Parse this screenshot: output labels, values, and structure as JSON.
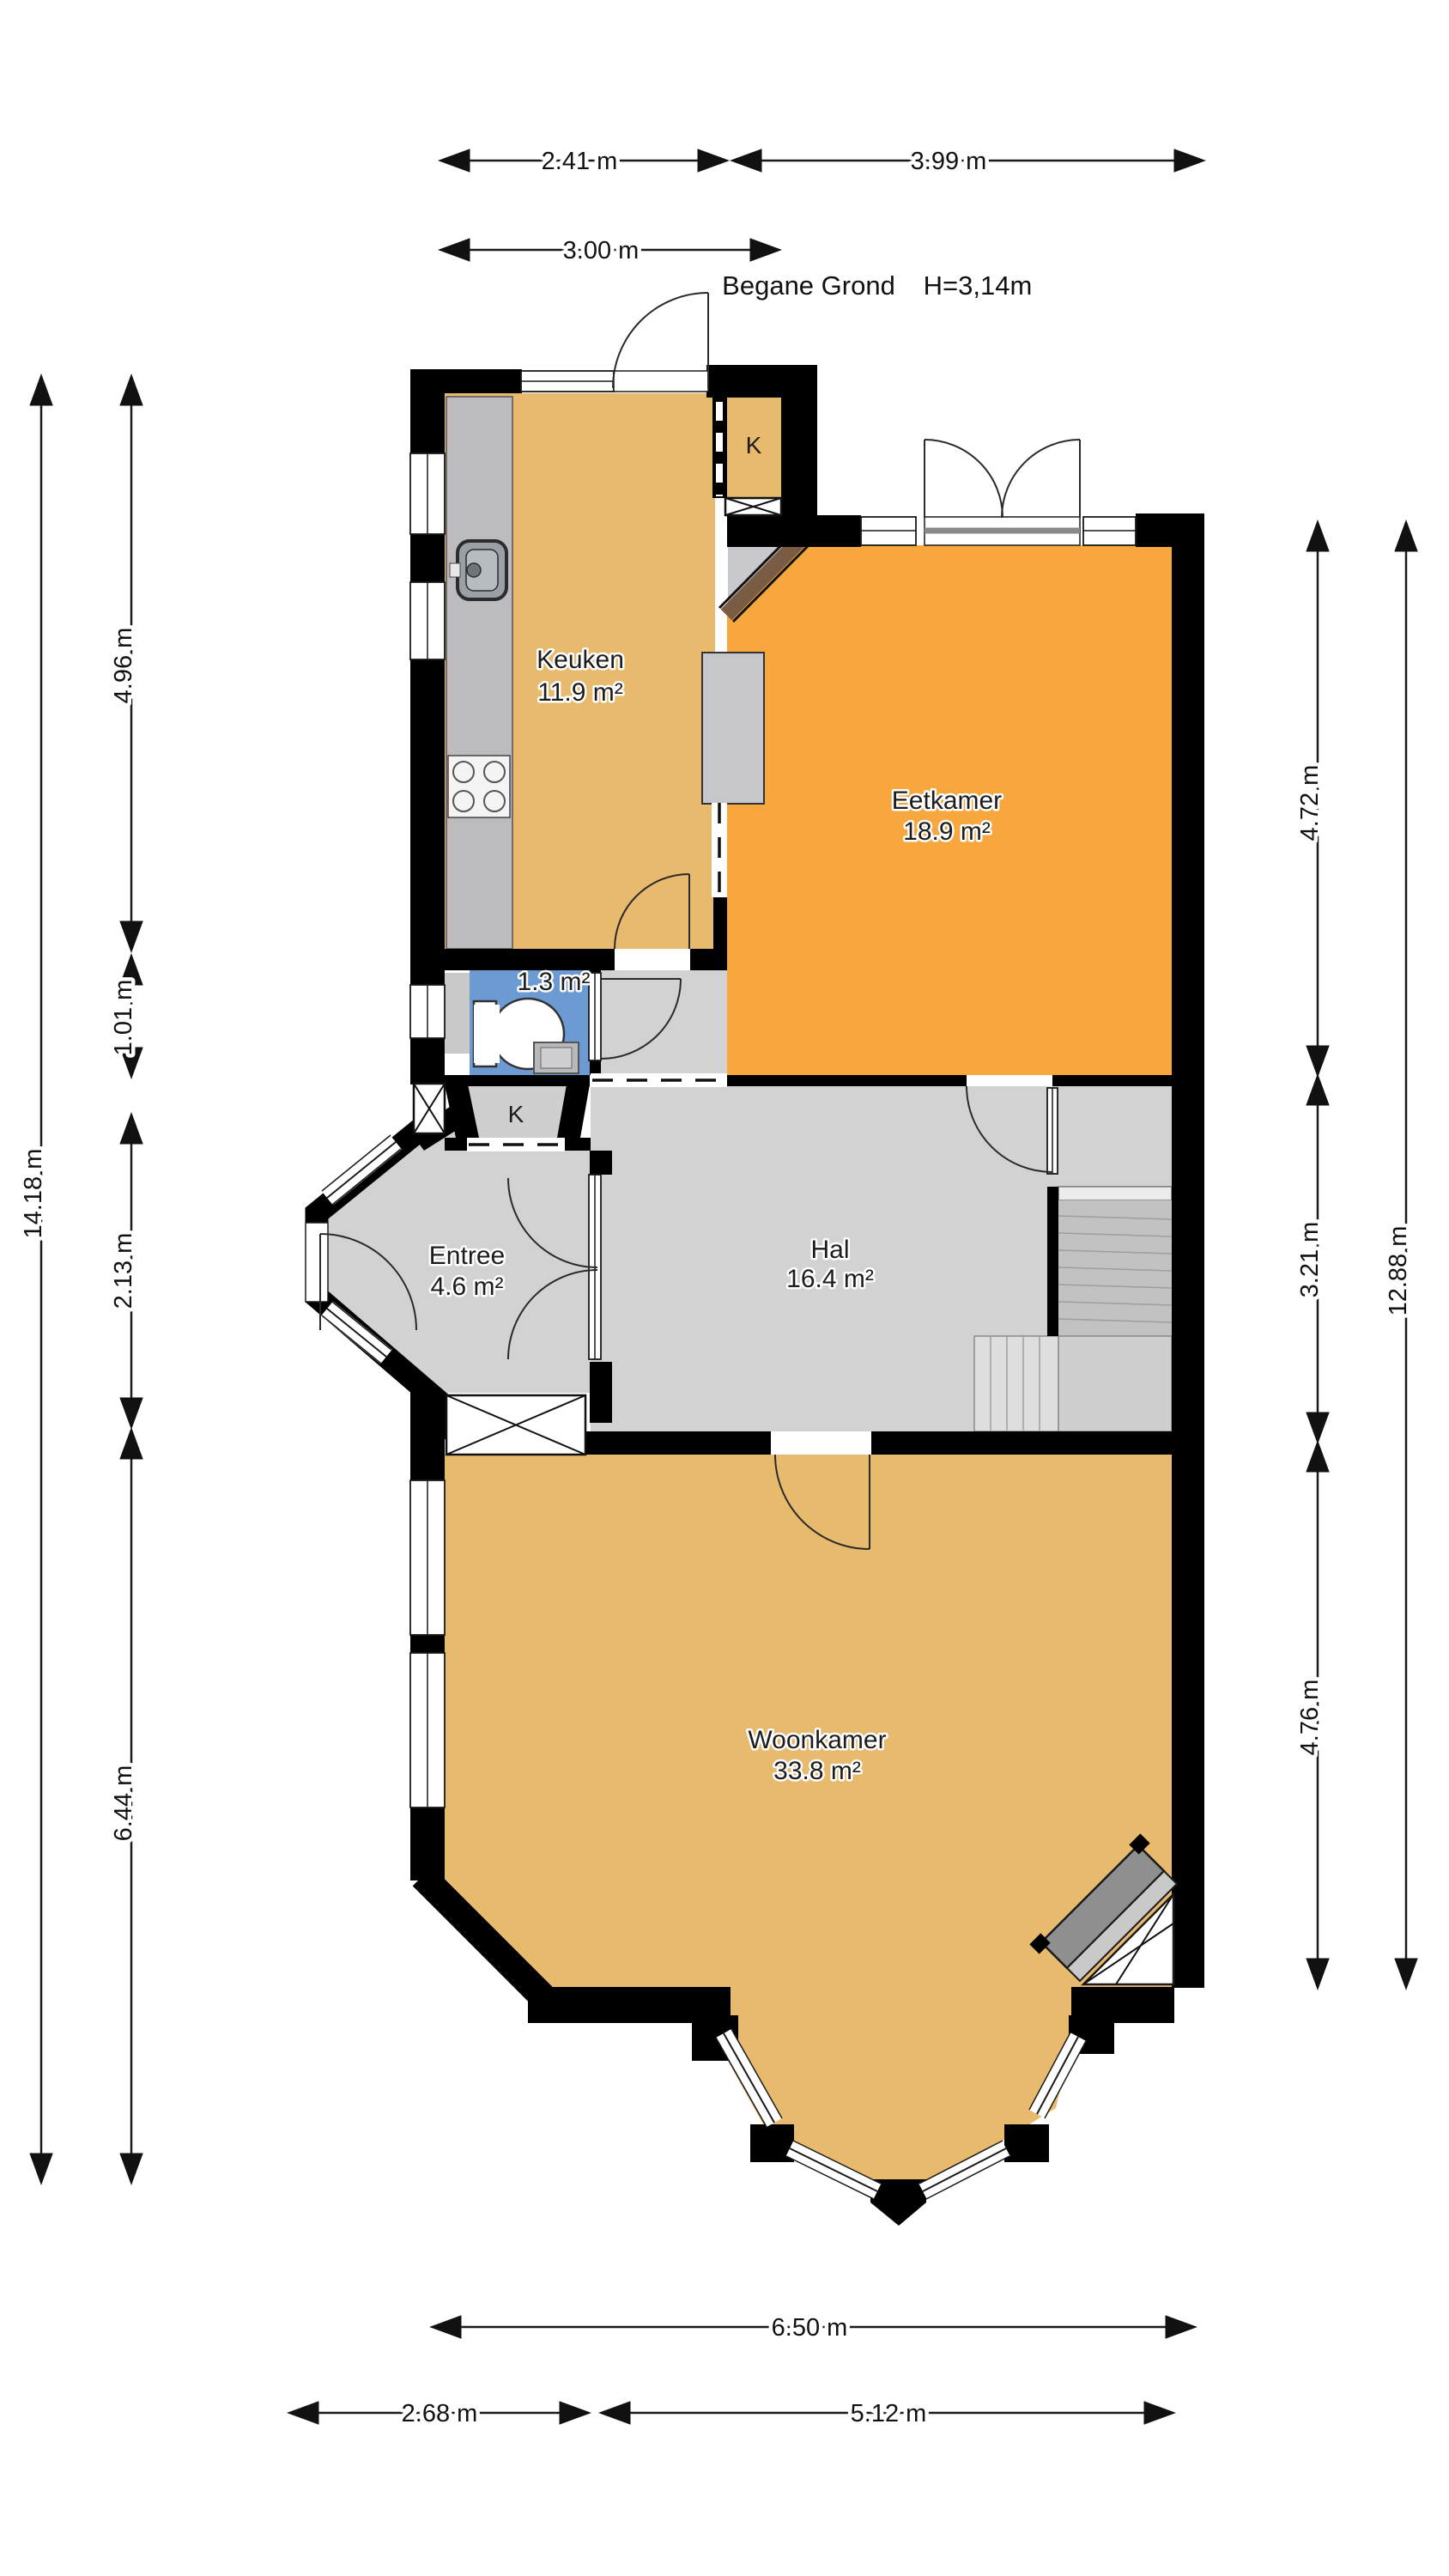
{
  "title": {
    "floor": "Begane Grond",
    "ceiling_height": "H=3,14m"
  },
  "rooms": {
    "keuken": {
      "name": "Keuken",
      "area": "11.9 m²"
    },
    "eetkamer": {
      "name": "Eetkamer",
      "area": "18.9 m²"
    },
    "toilet": {
      "area": "1.3 m²"
    },
    "entree": {
      "name": "Entree",
      "area": "4.6 m²"
    },
    "hal": {
      "name": "Hal",
      "area": "16.4 m²"
    },
    "woonkamer": {
      "name": "Woonkamer",
      "area": "33.8 m²"
    },
    "closet_top": {
      "label": "K"
    },
    "closet_hall": {
      "label": "K"
    }
  },
  "dimensions": {
    "top": {
      "d1": "2.41 m",
      "d2": "3.99 m",
      "d3": "3.00 m"
    },
    "left": {
      "d1": "4.96 m",
      "d2": "1.01 m",
      "d3": "2.13 m",
      "d4": "6.44 m",
      "total": "14.18 m"
    },
    "right": {
      "d1": "4.72 m",
      "d2": "3.21 m",
      "d3": "4.76 m",
      "total": "12.88 m"
    },
    "bottom": {
      "total": "6.50 m",
      "d1": "2.68 m",
      "d2": "5.12 m"
    }
  },
  "colors": {
    "wood_floor": "#e8ba6e",
    "dining_floor": "#f7a73d",
    "hall_floor": "#d2d2d2",
    "toilet_floor": "#6b9bd2",
    "closet_floor": "#cfcfcf",
    "counter": "#bcbcc0",
    "island": "#c7c7cb",
    "wall": "#000000"
  }
}
